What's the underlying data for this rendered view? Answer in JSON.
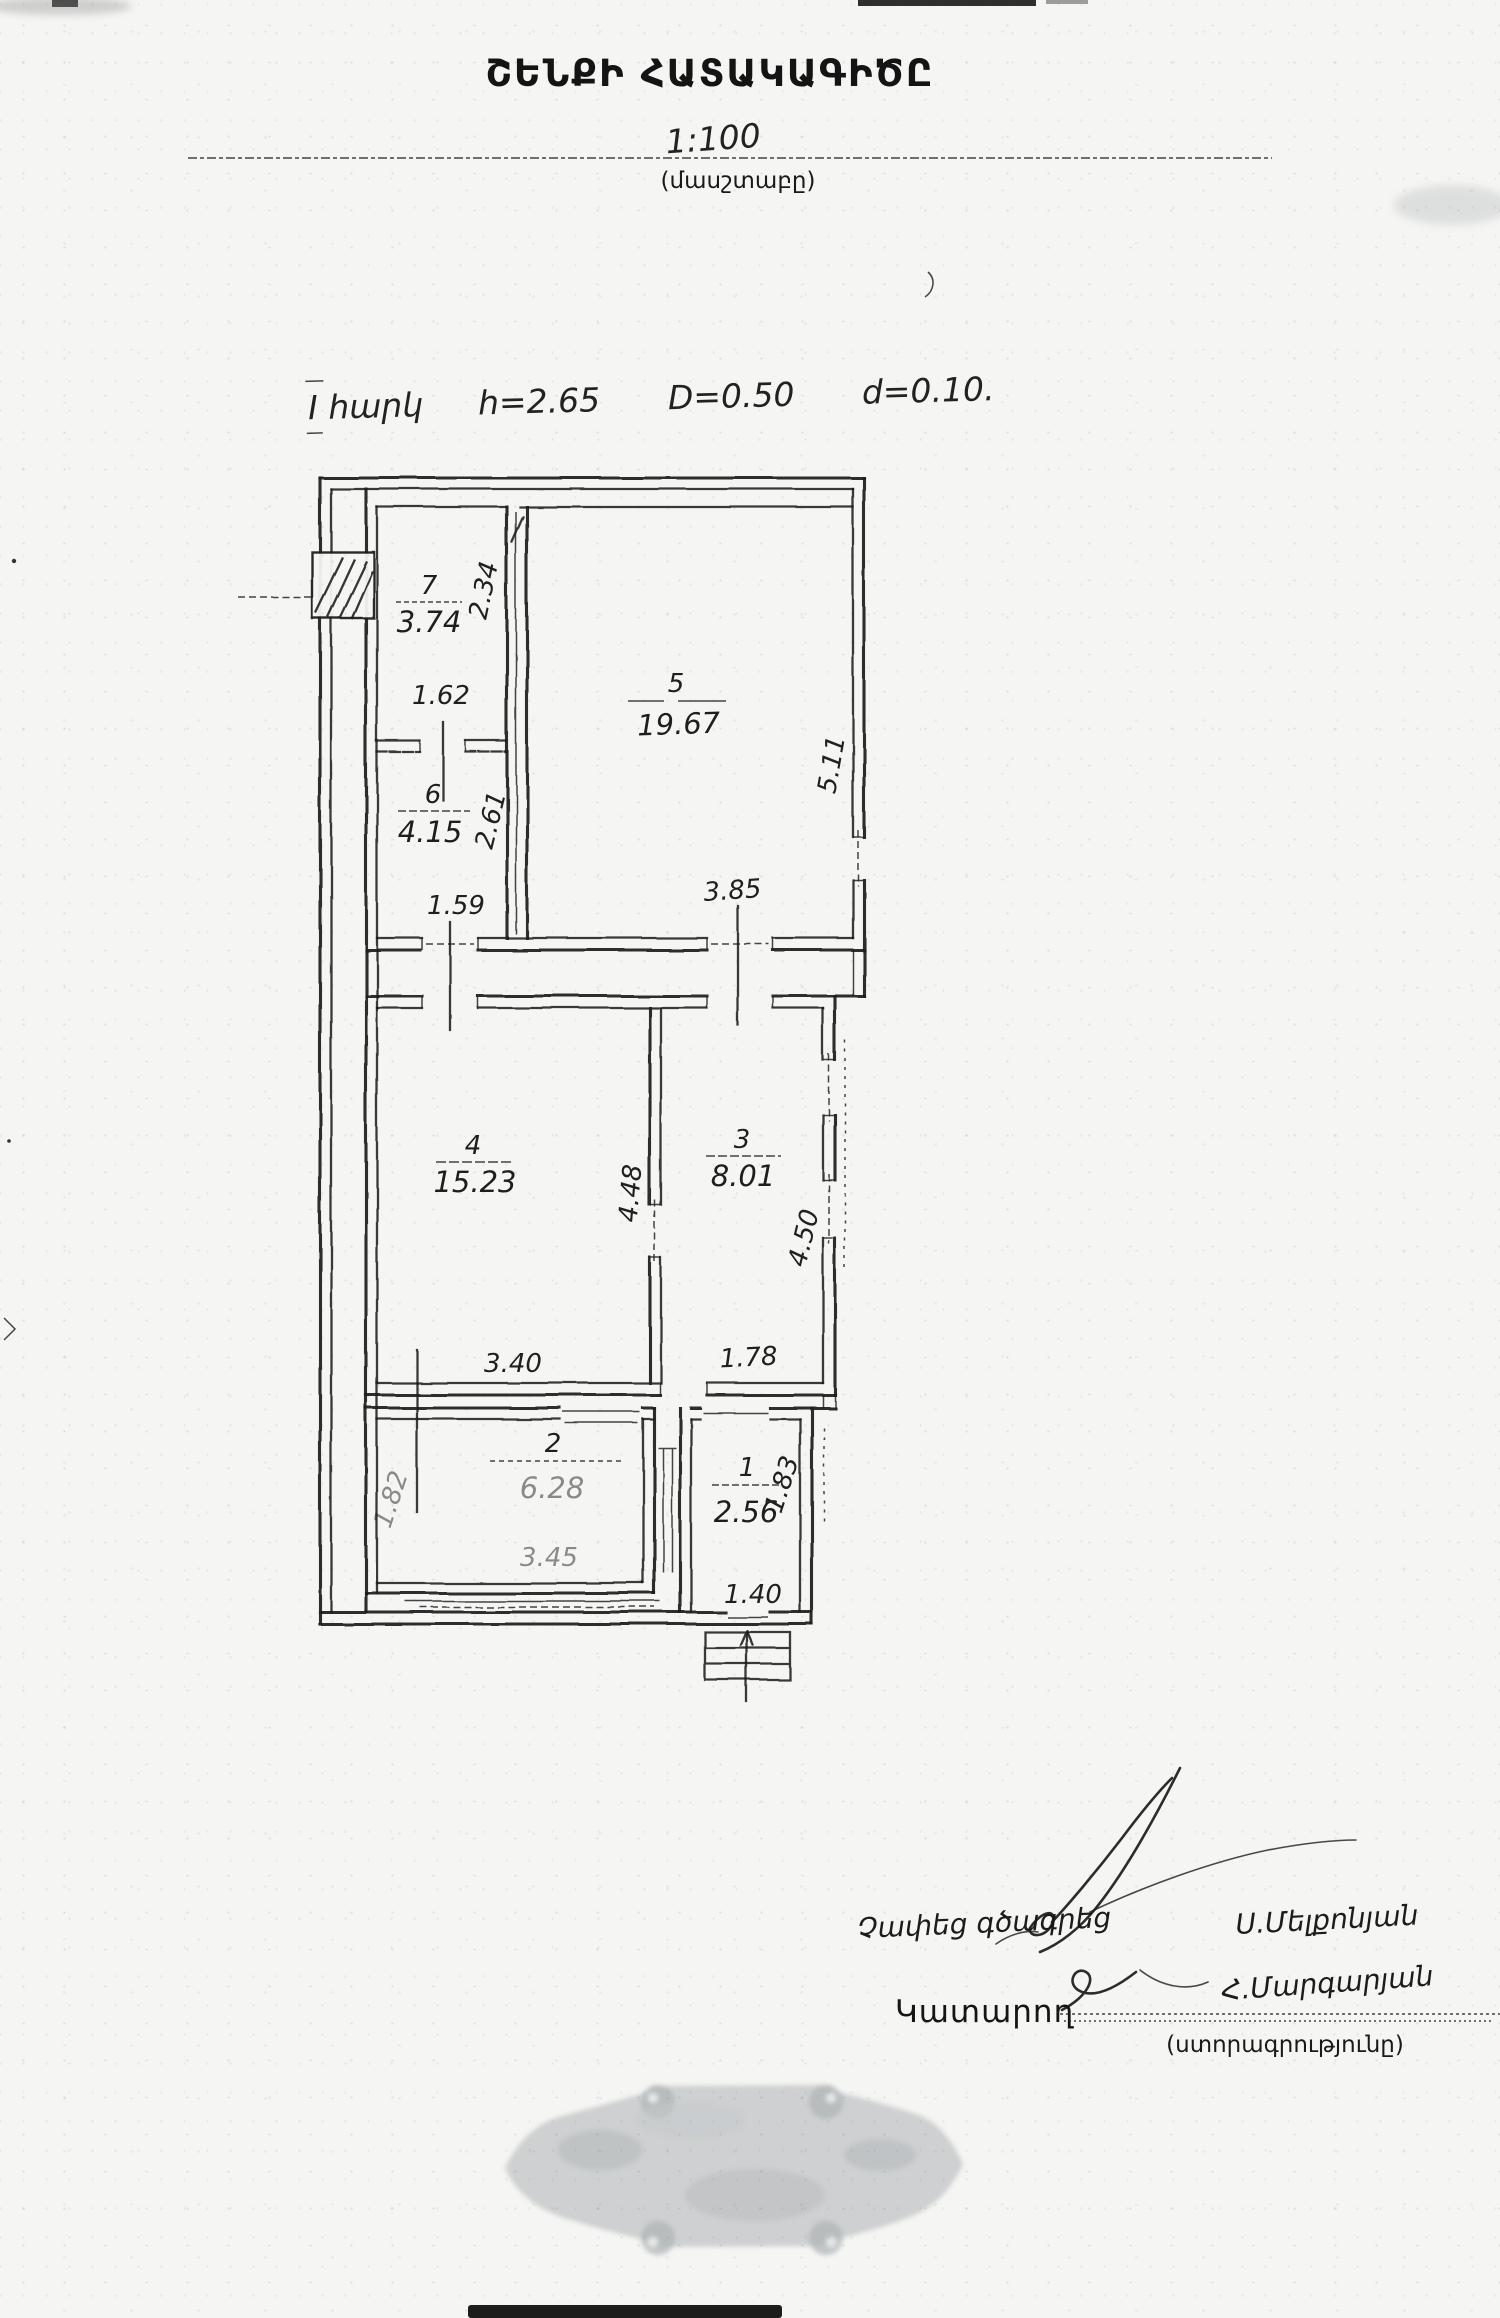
{
  "header": {
    "title": "ՇԵՆՔԻ ՀԱՏԱԿԱԳԻԾԸ",
    "scale_value": "1:100",
    "scale_caption": "(մասշտաբը)"
  },
  "note": {
    "floor": "I հարկ",
    "h": "h=2.65",
    "D": "D=0.50",
    "d": "d=0.10."
  },
  "plan": {
    "rooms": [
      {
        "number": "7",
        "area": "3.74",
        "width_dim": "1.62",
        "height_dim": "2.34"
      },
      {
        "number": "6",
        "area": "4.15",
        "width_dim": "1.59",
        "height_dim": "2.61"
      },
      {
        "number": "5",
        "area": "19.67",
        "width_dim": "3.85",
        "height_dim": "5.11"
      },
      {
        "number": "4",
        "area": "15.23",
        "width_dim": "3.40",
        "height_dim": "4.48"
      },
      {
        "number": "3",
        "area": "8.01",
        "width_dim": "1.78",
        "height_dim": "4.50"
      },
      {
        "number": "2",
        "area": "6.28",
        "width_dim": "3.45",
        "height_dim": "1.82"
      },
      {
        "number": "1",
        "area": "2.56",
        "width_dim": "1.40",
        "height_dim": "1.83"
      }
    ]
  },
  "signatures": {
    "measured_note": "Չափեց գծագրեց",
    "surveyor_name": "Ս.Մելքոնյան",
    "performer_label": "Կատարող",
    "performer_name": "Հ.Մարգարյան",
    "signature_caption": "(ստորագրությունը)"
  },
  "colors": {
    "ink": "#1b1b1b",
    "paper": "#f5f5f3",
    "stamp_gray": "#b6babc"
  }
}
